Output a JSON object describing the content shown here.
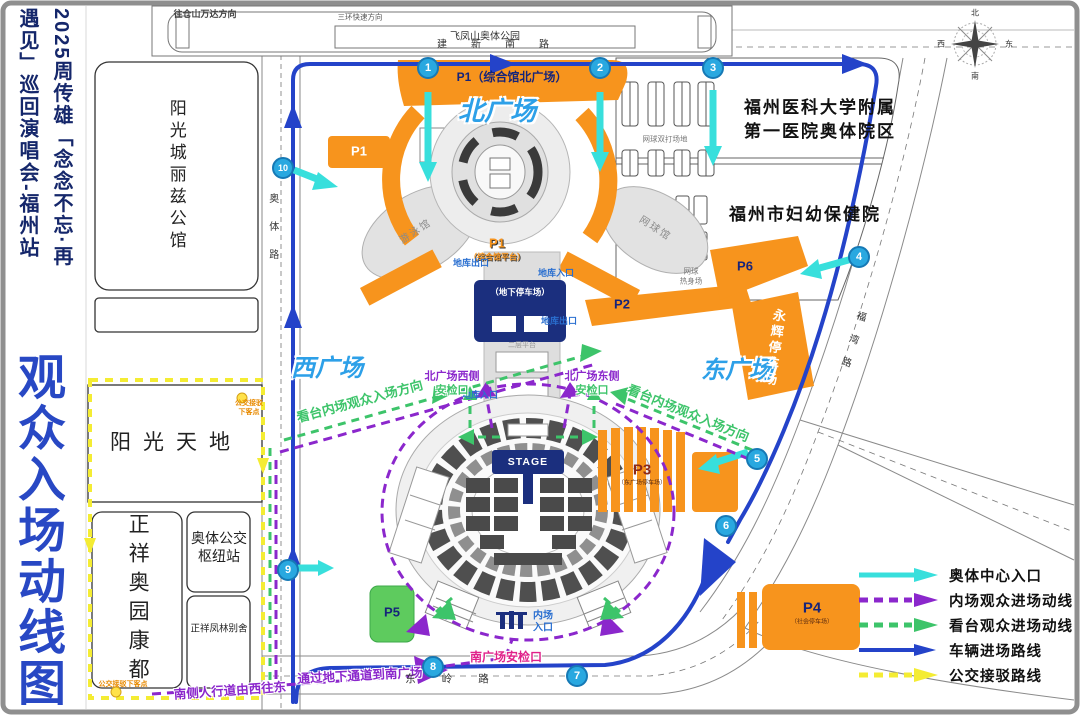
{
  "sidebar": {
    "title_col_right": "2025周传雄「念念不忘·再",
    "title_col_left": "遇见」巡回演唱会-福州站",
    "big_title": "观众入场动线图"
  },
  "map": {
    "north_strip": {
      "direction_label": "往仓山万达方向",
      "sub_label": "三环快速方向",
      "box_label": "飞凤山奥体公园"
    },
    "buildings": {
      "lizi": "阳光城丽兹公馆",
      "sunshine": "阳光天地",
      "zhengxiang": "正祥奥园康都",
      "bus_hub_l1": "奥体公交",
      "bus_hub_l2": "枢纽站",
      "fenglin": "正祥凤林别舍",
      "hospital1_l1": "福州医科大学附属",
      "hospital1_l2": "第一医院奥体院区",
      "hospital2": "福州市妇幼保健院",
      "swim": "游泳馆",
      "tennis_hall": "网球馆",
      "courts_doubles": "网球双打场地",
      "courts_warmup_l1": "网球",
      "courts_warmup_l2": "热身场"
    },
    "plazas": {
      "north": "北广场",
      "west": "西广场",
      "east": "东广场"
    },
    "parking": {
      "p1_top": "P1（综合馆北广场）",
      "p1_platform_l1": "P1",
      "p1_platform_l2": "（综合馆平台）",
      "p2": "P2",
      "p3": "P3",
      "p3_sub": "（东广场停车场）",
      "p4": "P4",
      "p4_sub": "（社会停车场）",
      "p5": "P5",
      "p6": "P6",
      "underground": "（地下停车场）",
      "yonghui": "永辉停车场"
    },
    "labels": {
      "garage_exit": "地库出口",
      "garage_entrance": "地库入口",
      "gate_west": "北广场西侧",
      "gate_east": "北广场东侧",
      "gate_check": "安检口",
      "south_gate": "南广场安检口",
      "inner_l1": "内场",
      "inner_l2": "入口",
      "platform_note": "二层平台",
      "stage": "STAGE",
      "dir_west": "看台内场观众入场方向",
      "dir_east": "看台内场观众入场方向",
      "south_sidewalk": "南侧人行道由西往东",
      "underpass": "通过地下通道到南广场",
      "bus_drop_l1": "公交接驳",
      "bus_drop_l2": "下客点",
      "bus_drop_bottom": "公交接驳下客点"
    },
    "roads": {
      "aoti": "奥体路",
      "jianxin": "建新南路",
      "dongling": "东岭路",
      "fuwan": "福湾路"
    },
    "markers": [
      "1",
      "2",
      "3",
      "4",
      "5",
      "6",
      "7",
      "8",
      "9",
      "10"
    ],
    "compass": {
      "n": "北",
      "s": "南",
      "e": "东",
      "w": "西"
    },
    "legend": [
      {
        "label": "奥体中心入口",
        "type": "cyan-solid"
      },
      {
        "label": "内场观众进场动线",
        "type": "purple-dashed"
      },
      {
        "label": "看台观众进场动线",
        "type": "green-dashed"
      },
      {
        "label": "车辆进场路线",
        "type": "blue-solid"
      },
      {
        "label": "公交接驳路线",
        "type": "yellow-dashed"
      }
    ]
  },
  "colors": {
    "cyan": "#38dfdc",
    "purple": "#8b27cc",
    "green": "#3dc46a",
    "blue": "#2443c9",
    "yellow": "#f4ec33",
    "orange": "#f7941d",
    "navy": "#1b2f7e",
    "plaza_blue": "#2da0e8",
    "badge_blue": "#29a8e0"
  }
}
